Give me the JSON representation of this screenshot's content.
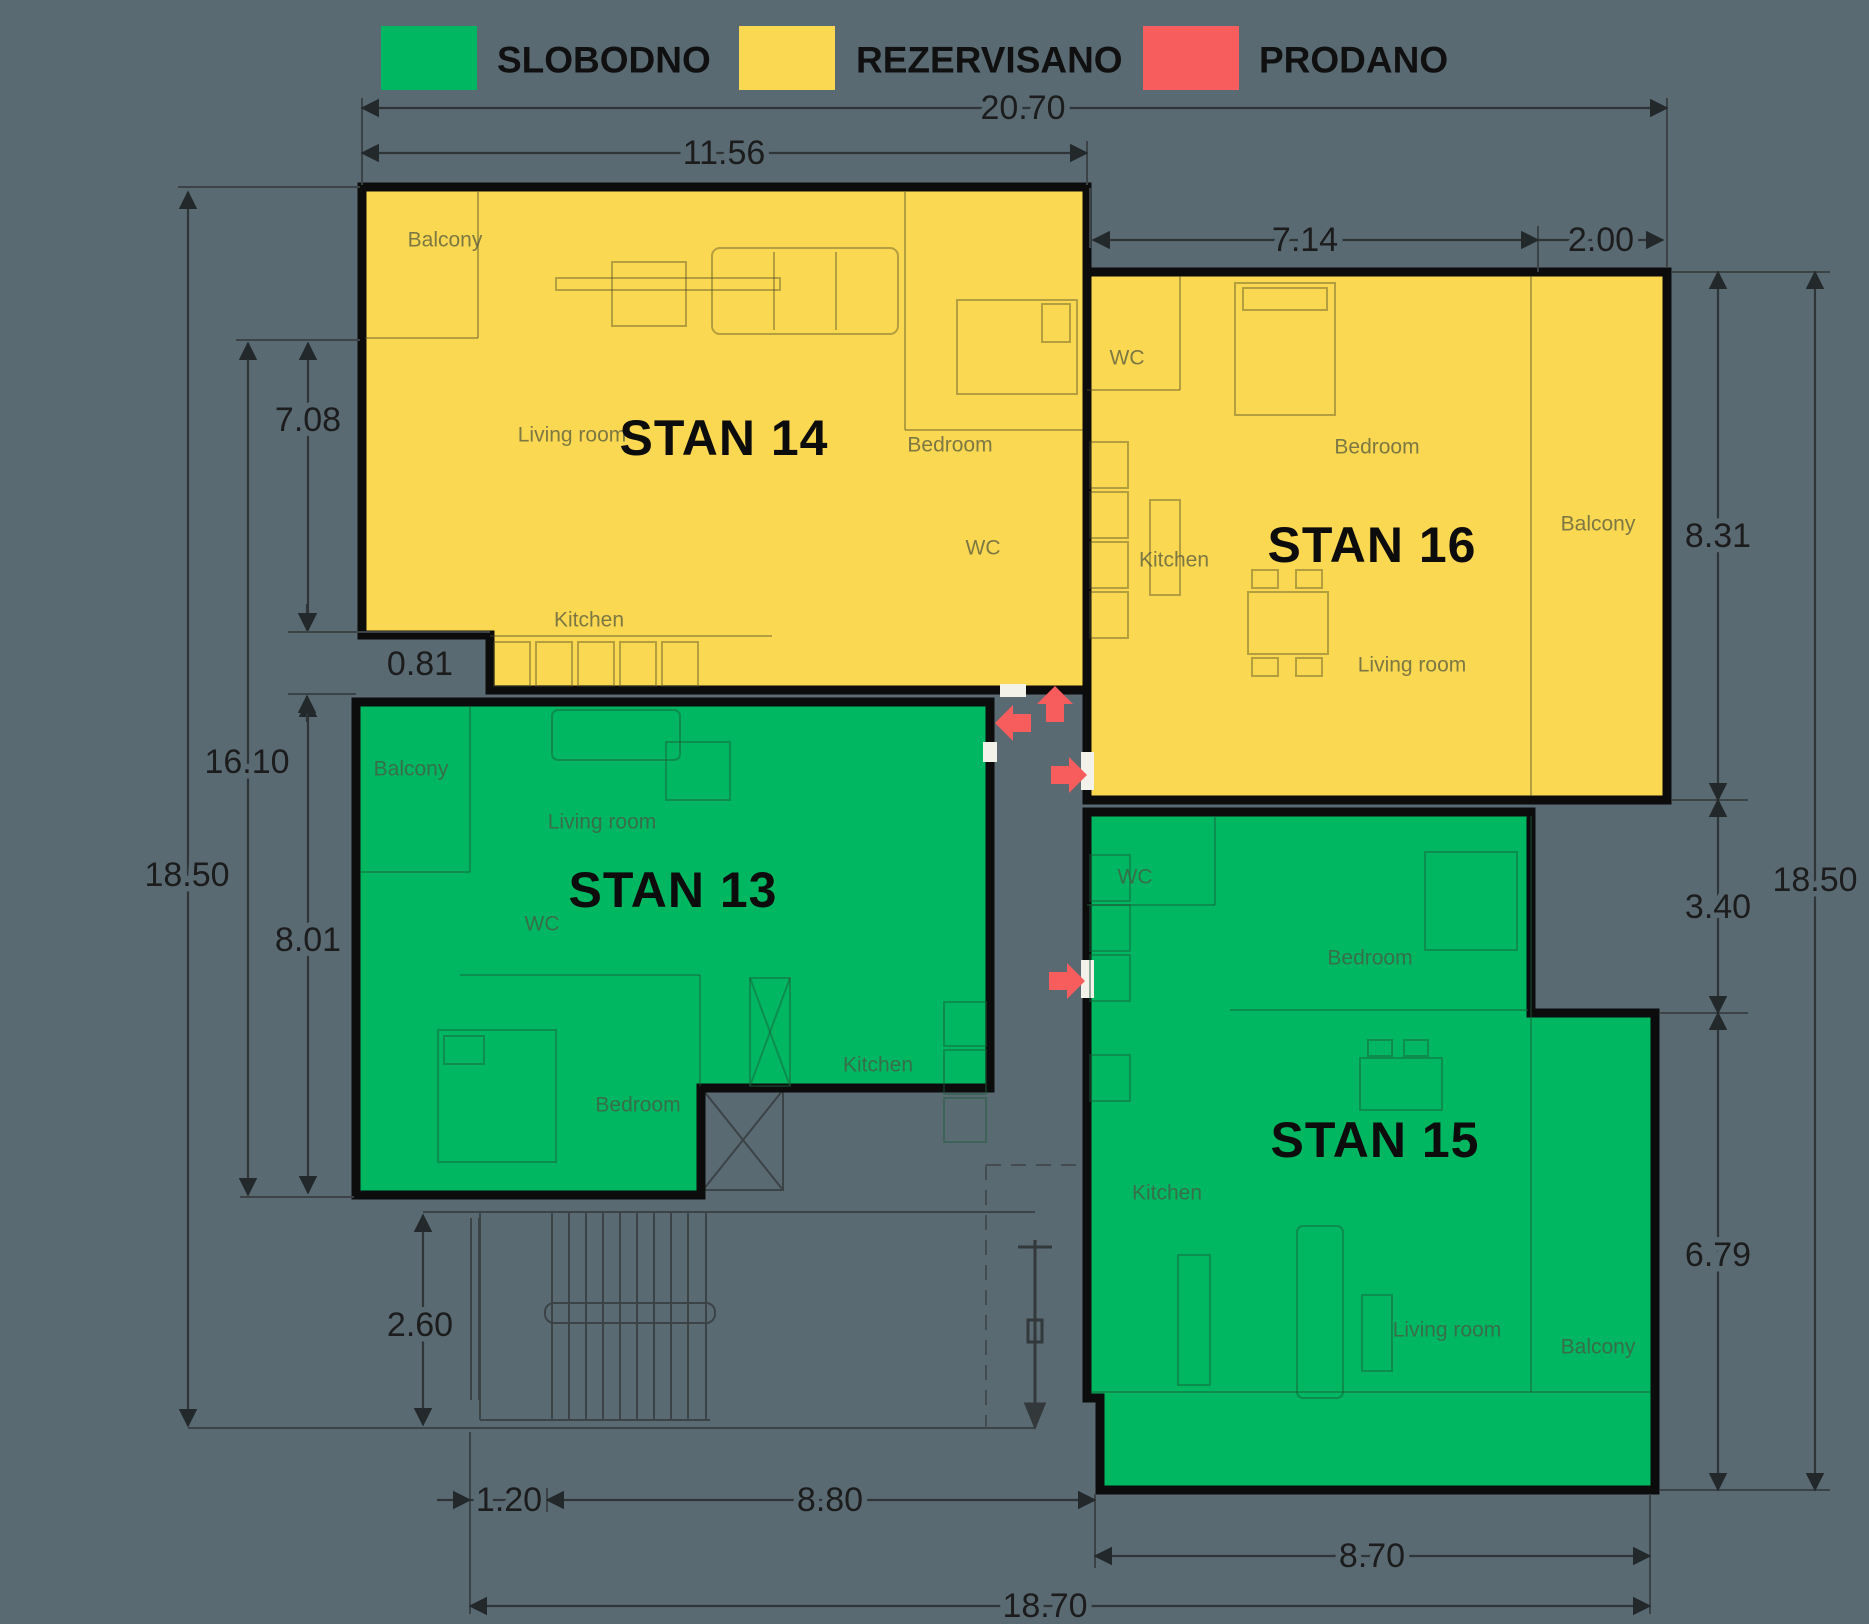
{
  "legend": {
    "slobodno": {
      "label": "SLOBODNO",
      "color": "#00b761"
    },
    "rezervisano": {
      "label": "REZERVISANO",
      "color": "#fbd851"
    },
    "prodano": {
      "label": "PRODANO",
      "color": "#f85d5d"
    }
  },
  "apartments": {
    "stan13": {
      "title": "STAN 13",
      "status": "SLOBODNO",
      "rooms": {
        "balcony": "Balcony",
        "living": "Living room",
        "wc": "WC",
        "kitchen": "Kitchen",
        "bedroom": "Bedroom"
      }
    },
    "stan14": {
      "title": "STAN 14",
      "status": "REZERVISANO",
      "rooms": {
        "balcony": "Balcony",
        "living": "Living room",
        "bedroom": "Bedroom",
        "wc": "WC",
        "kitchen": "Kitchen"
      }
    },
    "stan15": {
      "title": "STAN 15",
      "status": "SLOBODNO",
      "rooms": {
        "wc": "WC",
        "bedroom": "Bedroom",
        "kitchen": "Kitchen",
        "living": "Living room",
        "balcony": "Balcony"
      }
    },
    "stan16": {
      "title": "STAN 16",
      "status": "REZERVISANO",
      "rooms": {
        "wc": "WC",
        "bedroom": "Bedroom",
        "balcony": "Balcony",
        "kitchen": "Kitchen",
        "living": "Living room"
      }
    }
  },
  "dimensions": {
    "top": {
      "total": "20.70",
      "stan14_width": "11.56",
      "stan16_width": "7.14",
      "balcony": "2.00"
    },
    "left": {
      "total": "18.50",
      "middle": "16.10",
      "upper": "7.08",
      "lower": "8.01",
      "gap": "0.81",
      "stairs": "2.60"
    },
    "right": {
      "stan16_height": "8.31",
      "step": "3.40",
      "stan15_height": "6.79",
      "total": "18.50"
    },
    "bottom": {
      "entry": "1.20",
      "stairs": "8.80",
      "stan15_width": "8.70",
      "total": "18.70"
    }
  }
}
